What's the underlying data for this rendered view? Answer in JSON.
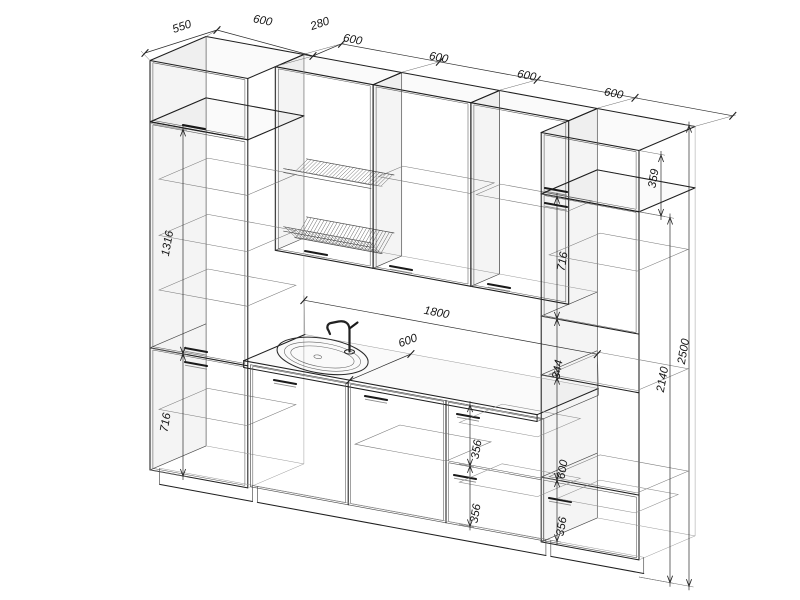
{
  "page": {
    "background": "#ffffff",
    "line_color": "#1f1f1f",
    "type": "technical-drawing",
    "subject": "kitchen cabinet set, axonometric wireframe projection with dimensions"
  },
  "drawing": {
    "units_implied": "mm",
    "dimensions": {
      "top_chain": [
        {
          "id": "tall-left-depth",
          "value": "550"
        },
        {
          "id": "tall-left-width",
          "value": "600"
        },
        {
          "id": "wall-cabinet-depth",
          "value": "280"
        },
        {
          "id": "wall-cabinet-1-width",
          "value": "600"
        },
        {
          "id": "wall-cabinet-2-width",
          "value": "600"
        },
        {
          "id": "wall-cabinet-3-width",
          "value": "600"
        },
        {
          "id": "tall-right-width",
          "value": "600"
        }
      ],
      "left_side": [
        {
          "id": "upper-door-height",
          "value": "1316"
        },
        {
          "id": "base-height",
          "value": "716"
        }
      ],
      "right_cabinet": [
        {
          "id": "top-box-height",
          "value": "359"
        },
        {
          "id": "mid-door-height",
          "value": "716"
        },
        {
          "id": "shelf-gap-height",
          "value": "344"
        },
        {
          "id": "niche-height",
          "value": "600"
        },
        {
          "id": "drawer-height",
          "value": "356"
        }
      ],
      "base_run": [
        {
          "id": "worktop-length",
          "value": "1800"
        },
        {
          "id": "worktop-depth",
          "value": "600"
        },
        {
          "id": "drawer-upper-height",
          "value": "356"
        },
        {
          "id": "drawer-lower-height",
          "value": "356"
        }
      ],
      "overall": [
        {
          "id": "tall-cabinet-height",
          "value": "2140"
        },
        {
          "id": "total-height",
          "value": "2500"
        }
      ]
    },
    "modules": [
      {
        "name": "tall-cabinet-left",
        "width": "600",
        "depth": "550",
        "parts": [
          "top-box",
          "upper-door",
          "base-door"
        ]
      },
      {
        "name": "wall-cabinet-1-dish-drainer",
        "width": "600",
        "depth": "280"
      },
      {
        "name": "wall-cabinet-2",
        "width": "600",
        "depth": "280"
      },
      {
        "name": "wall-cabinet-3",
        "width": "600",
        "depth": "280"
      },
      {
        "name": "tall-cabinet-right",
        "width": "600",
        "depth": "550",
        "parts": [
          "top-box",
          "door",
          "open-shelf",
          "niche",
          "drawer"
        ]
      },
      {
        "name": "sink-base-cabinet",
        "width": "600"
      },
      {
        "name": "door-base-cabinet",
        "width": "600"
      },
      {
        "name": "drawer-base-cabinet",
        "width": "600"
      },
      {
        "name": "worktop-with-sink-and-mixer-tap",
        "length": "1800",
        "depth": "600"
      }
    ]
  }
}
